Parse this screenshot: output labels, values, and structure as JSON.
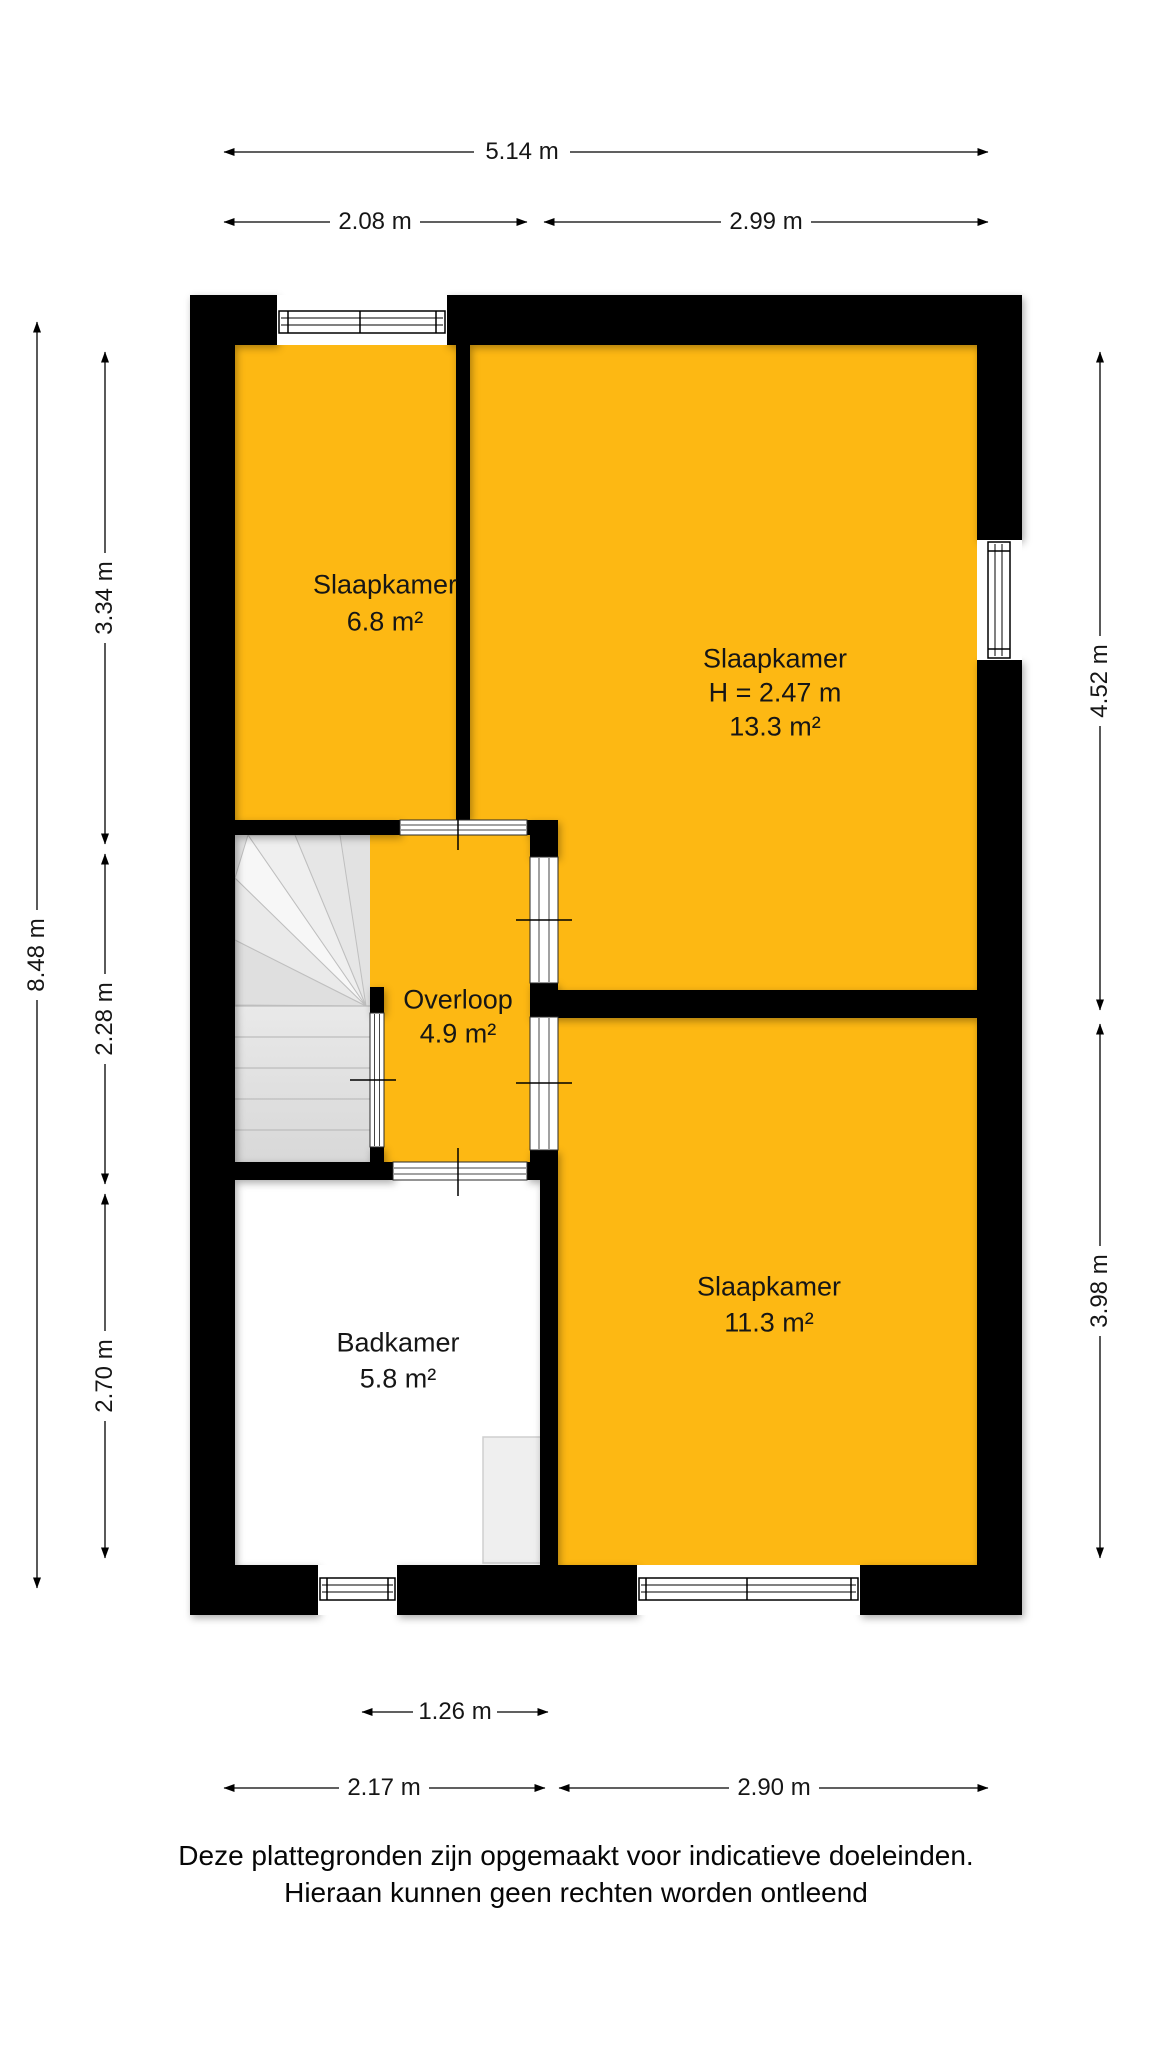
{
  "floorplan": {
    "rooms": {
      "slaapkamer1": {
        "label": "Slaapkamer",
        "area": "6.8 m²"
      },
      "slaapkamer2": {
        "label": "Slaapkamer",
        "height": "H = 2.47 m",
        "area": "13.3 m²"
      },
      "overloop": {
        "label": "Overloop",
        "area": "4.9 m²"
      },
      "badkamer": {
        "label": "Badkamer",
        "area": "5.8 m²"
      },
      "slaapkamer3": {
        "label": "Slaapkamer",
        "area": "11.3 m²"
      }
    },
    "dimensions": {
      "top_total": "5.14 m",
      "top_left": "2.08 m",
      "top_right": "2.99 m",
      "left_total": "8.48 m",
      "left_top": "3.34 m",
      "left_middle": "2.28 m",
      "left_bottom": "2.70 m",
      "right_top": "4.52 m",
      "right_bottom": "3.98 m",
      "bottom_opening": "1.26 m",
      "bottom_left": "2.17 m",
      "bottom_right": "2.90 m"
    },
    "colors": {
      "room_fill": "#fdb813",
      "wall": "#000000",
      "stairs": "#e2e2e2",
      "fixture": "#efefef"
    },
    "footer": {
      "line1": "Deze plattegronden zijn opgemaakt voor indicatieve doeleinden.",
      "line2": "Hieraan kunnen geen rechten worden ontleend"
    }
  }
}
